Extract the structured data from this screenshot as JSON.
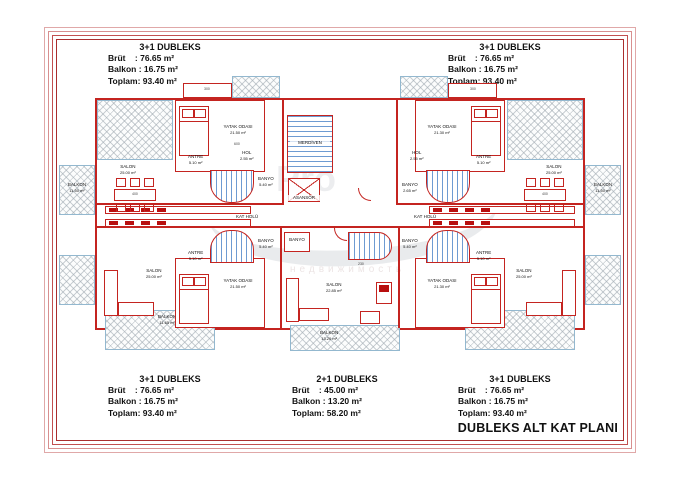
{
  "plan_title": "DUBLEKS ALT KAT PLANI",
  "info_blocks": {
    "top_left": {
      "title": "3+1 DUBLEKS",
      "line1": "Brüt    : 76.65 m²",
      "line2": "Balkon : 16.75 m²",
      "line3": "Toplam: 93.40 m²"
    },
    "top_right": {
      "title": "3+1 DUBLEKS",
      "line1": "Brüt    : 76.65 m²",
      "line2": "Balkon : 16.75 m²",
      "line3": "Toplam: 93.40 m²"
    },
    "bottom_left": {
      "title": "3+1 DUBLEKS",
      "line1": "Brüt    : 76.65 m²",
      "line2": "Balkon : 16.75 m²",
      "line3": "Toplam: 93.40 m²"
    },
    "bottom_center": {
      "title": "2+1 DUBLEKS",
      "line1": "Brüt    : 45.00 m²",
      "line2": "Balkon : 13.20 m²",
      "line3": "Toplam: 58.20 m²"
    },
    "bottom_right": {
      "title": "3+1 DUBLEKS",
      "line1": "Brüt    : 76.65 m²",
      "line2": "Balkon : 16.75 m²",
      "line3": "Toplam: 93.40 m²"
    }
  },
  "rooms": {
    "yatak_label": "YATAK ODASI",
    "yatak_area_left": "21.50 m²",
    "yatak_area_right": "21.30 m²",
    "salon_label": "SALON",
    "salon_area": "25.00 m²",
    "salon_area_2p1": "22.85 m²",
    "antre_label": "ANTRE",
    "antre_area": "5.10 m²",
    "hol_label": "HOL",
    "hol_area": "2.55 m²",
    "banyo_label": "BANYO",
    "banyo_area": "5.40 m²",
    "banyo_area_small": "2.65 m²",
    "merdiven": "MERDİVEN",
    "asansor": "ASANSÖR",
    "kat_holu": "KAT HOLÜ",
    "balkon_label": "BALKON",
    "balkon_area_side": "11.50 m²",
    "balkon_area_corner": "11.65 m²",
    "balkon_area_center": "13.20 m²"
  },
  "dims": [
    "300",
    "400",
    "600",
    "230",
    "300",
    "400"
  ],
  "watermark": {
    "text": "Pro",
    "subtext": "недвижимость"
  },
  "colors": {
    "wall": "#c42420",
    "stair": "#6e9bd2",
    "hatch_border": "#93b8cf",
    "frame": "#aa2e2e"
  }
}
